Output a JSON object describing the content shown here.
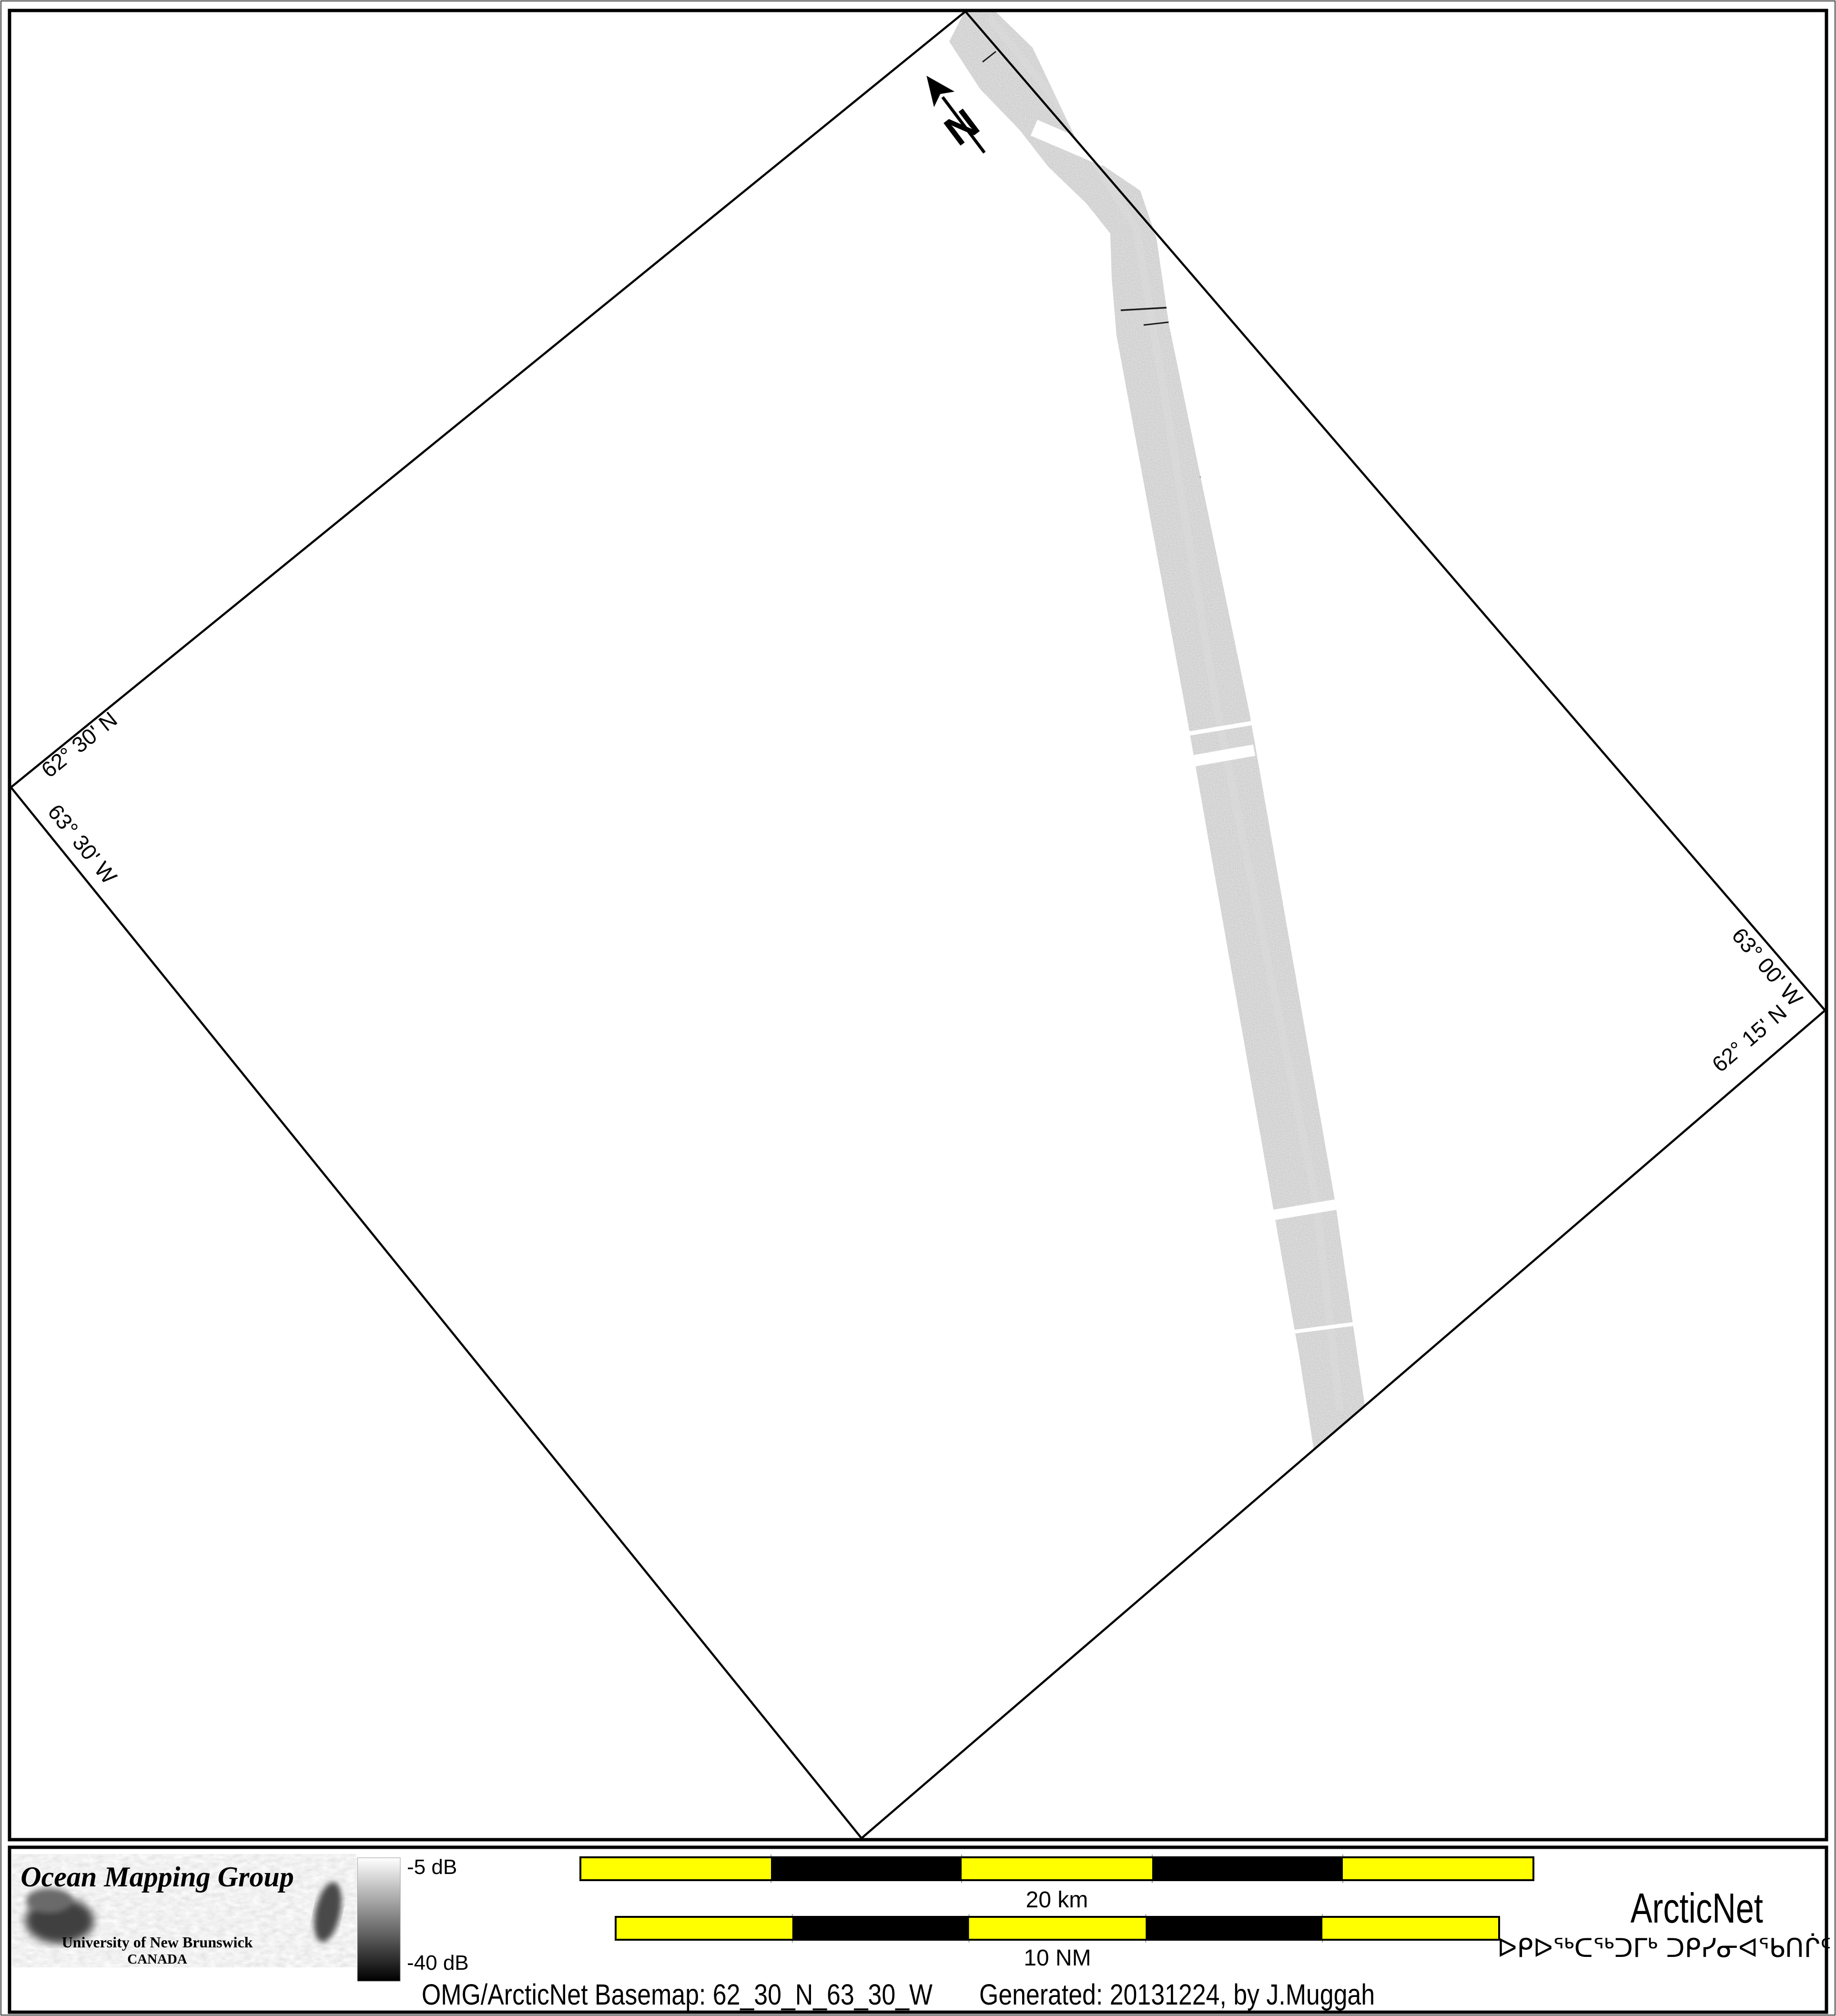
{
  "page": {
    "background": "#ffffff"
  },
  "map": {
    "graticule_labels": {
      "top_left_lat": "62° 30' N",
      "left_lon": "63° 30' W",
      "right_lon": "63° 00' W",
      "bottom_right_lat": "62° 15' N"
    },
    "north_arrow": {
      "label": "N"
    }
  },
  "legend": {
    "omg_logo": {
      "title": "Ocean Mapping Group",
      "subtitle": "University of New Brunswick",
      "country": "CANADA",
      "title_color": "#a31622",
      "subtitle_color": "#232a9e"
    },
    "colorbar": {
      "top_label": "-5 dB",
      "bottom_label": "-40 dB",
      "top_color": "#ffffff",
      "bottom_color": "#000000"
    },
    "scalebar_km": {
      "label": "20 km",
      "segments": 5,
      "color_a": "#ffff00",
      "color_b": "#000000"
    },
    "scalebar_nm": {
      "label": "10 NM",
      "segments": 5,
      "color_a": "#ffff00",
      "color_b": "#000000"
    },
    "arcticnet_logo": {
      "name": "ArcticNet",
      "inuktitut": "ᐅᑭᐅᖅᑕᖅᑐᒥᒃ ᑐᑭᓯᓂᐊᖃᑎᒌᑦ",
      "name_color": "#7aa5da",
      "inuktitut_color": "#2c3e55"
    },
    "caption": {
      "basemap": "OMG/ArcticNet Basemap: 62_30_N_63_30_W",
      "generated": "Generated: 20131224, by J.Muggah"
    }
  }
}
